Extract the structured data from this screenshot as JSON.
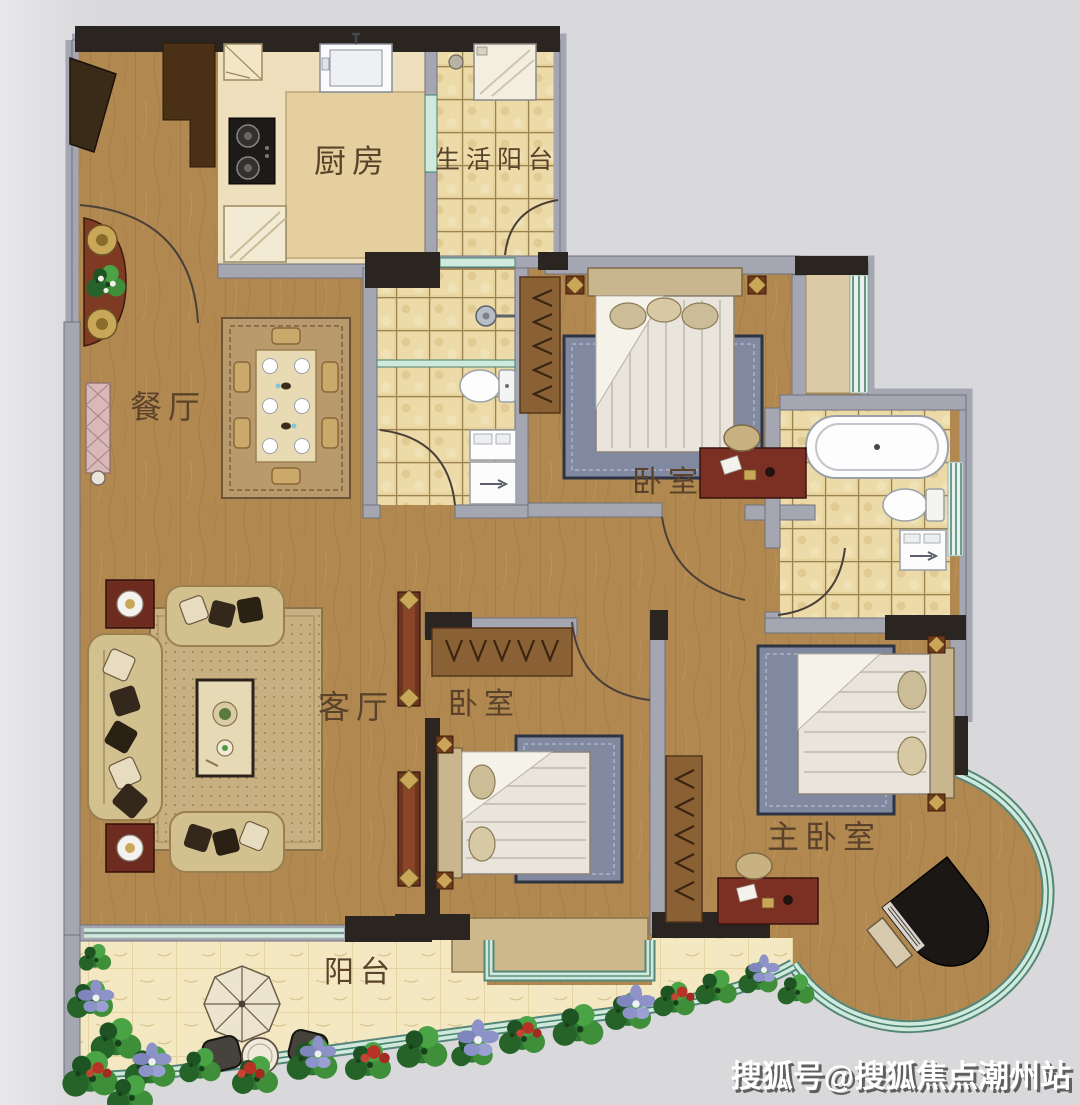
{
  "rooms": {
    "kitchen": {
      "label": "厨房"
    },
    "utility_balcony": {
      "label": "生活阳台"
    },
    "dining": {
      "label": "餐厅"
    },
    "bedroom_upper": {
      "label": "卧室"
    },
    "bedroom_middle": {
      "label": "卧室"
    },
    "living": {
      "label": "客厅"
    },
    "master_bedroom": {
      "label": "主卧室"
    },
    "balcony": {
      "label": "阳台"
    }
  },
  "watermark": {
    "text": "搜狐号@搜狐焦点潮州站"
  },
  "colors": {
    "background": "#d9d8da",
    "wall_gray": "#a4a7b2",
    "wall_dark": "#2b2522",
    "wood_floor": "#b28851",
    "kitchen_floor": "#efe0bd",
    "tile_floor": "#e7d29c",
    "balcony_floor": "#f4e8c2",
    "glass_teal": "#cfe9dc",
    "glass_line": "#47806e",
    "label_text": "#5a432a",
    "plant_green": "#2e7a33",
    "flower_purple": "#8d93c8",
    "flower_red": "#b83326",
    "desk_wood": "#7c3024",
    "rug_blue": "#8089a0"
  }
}
